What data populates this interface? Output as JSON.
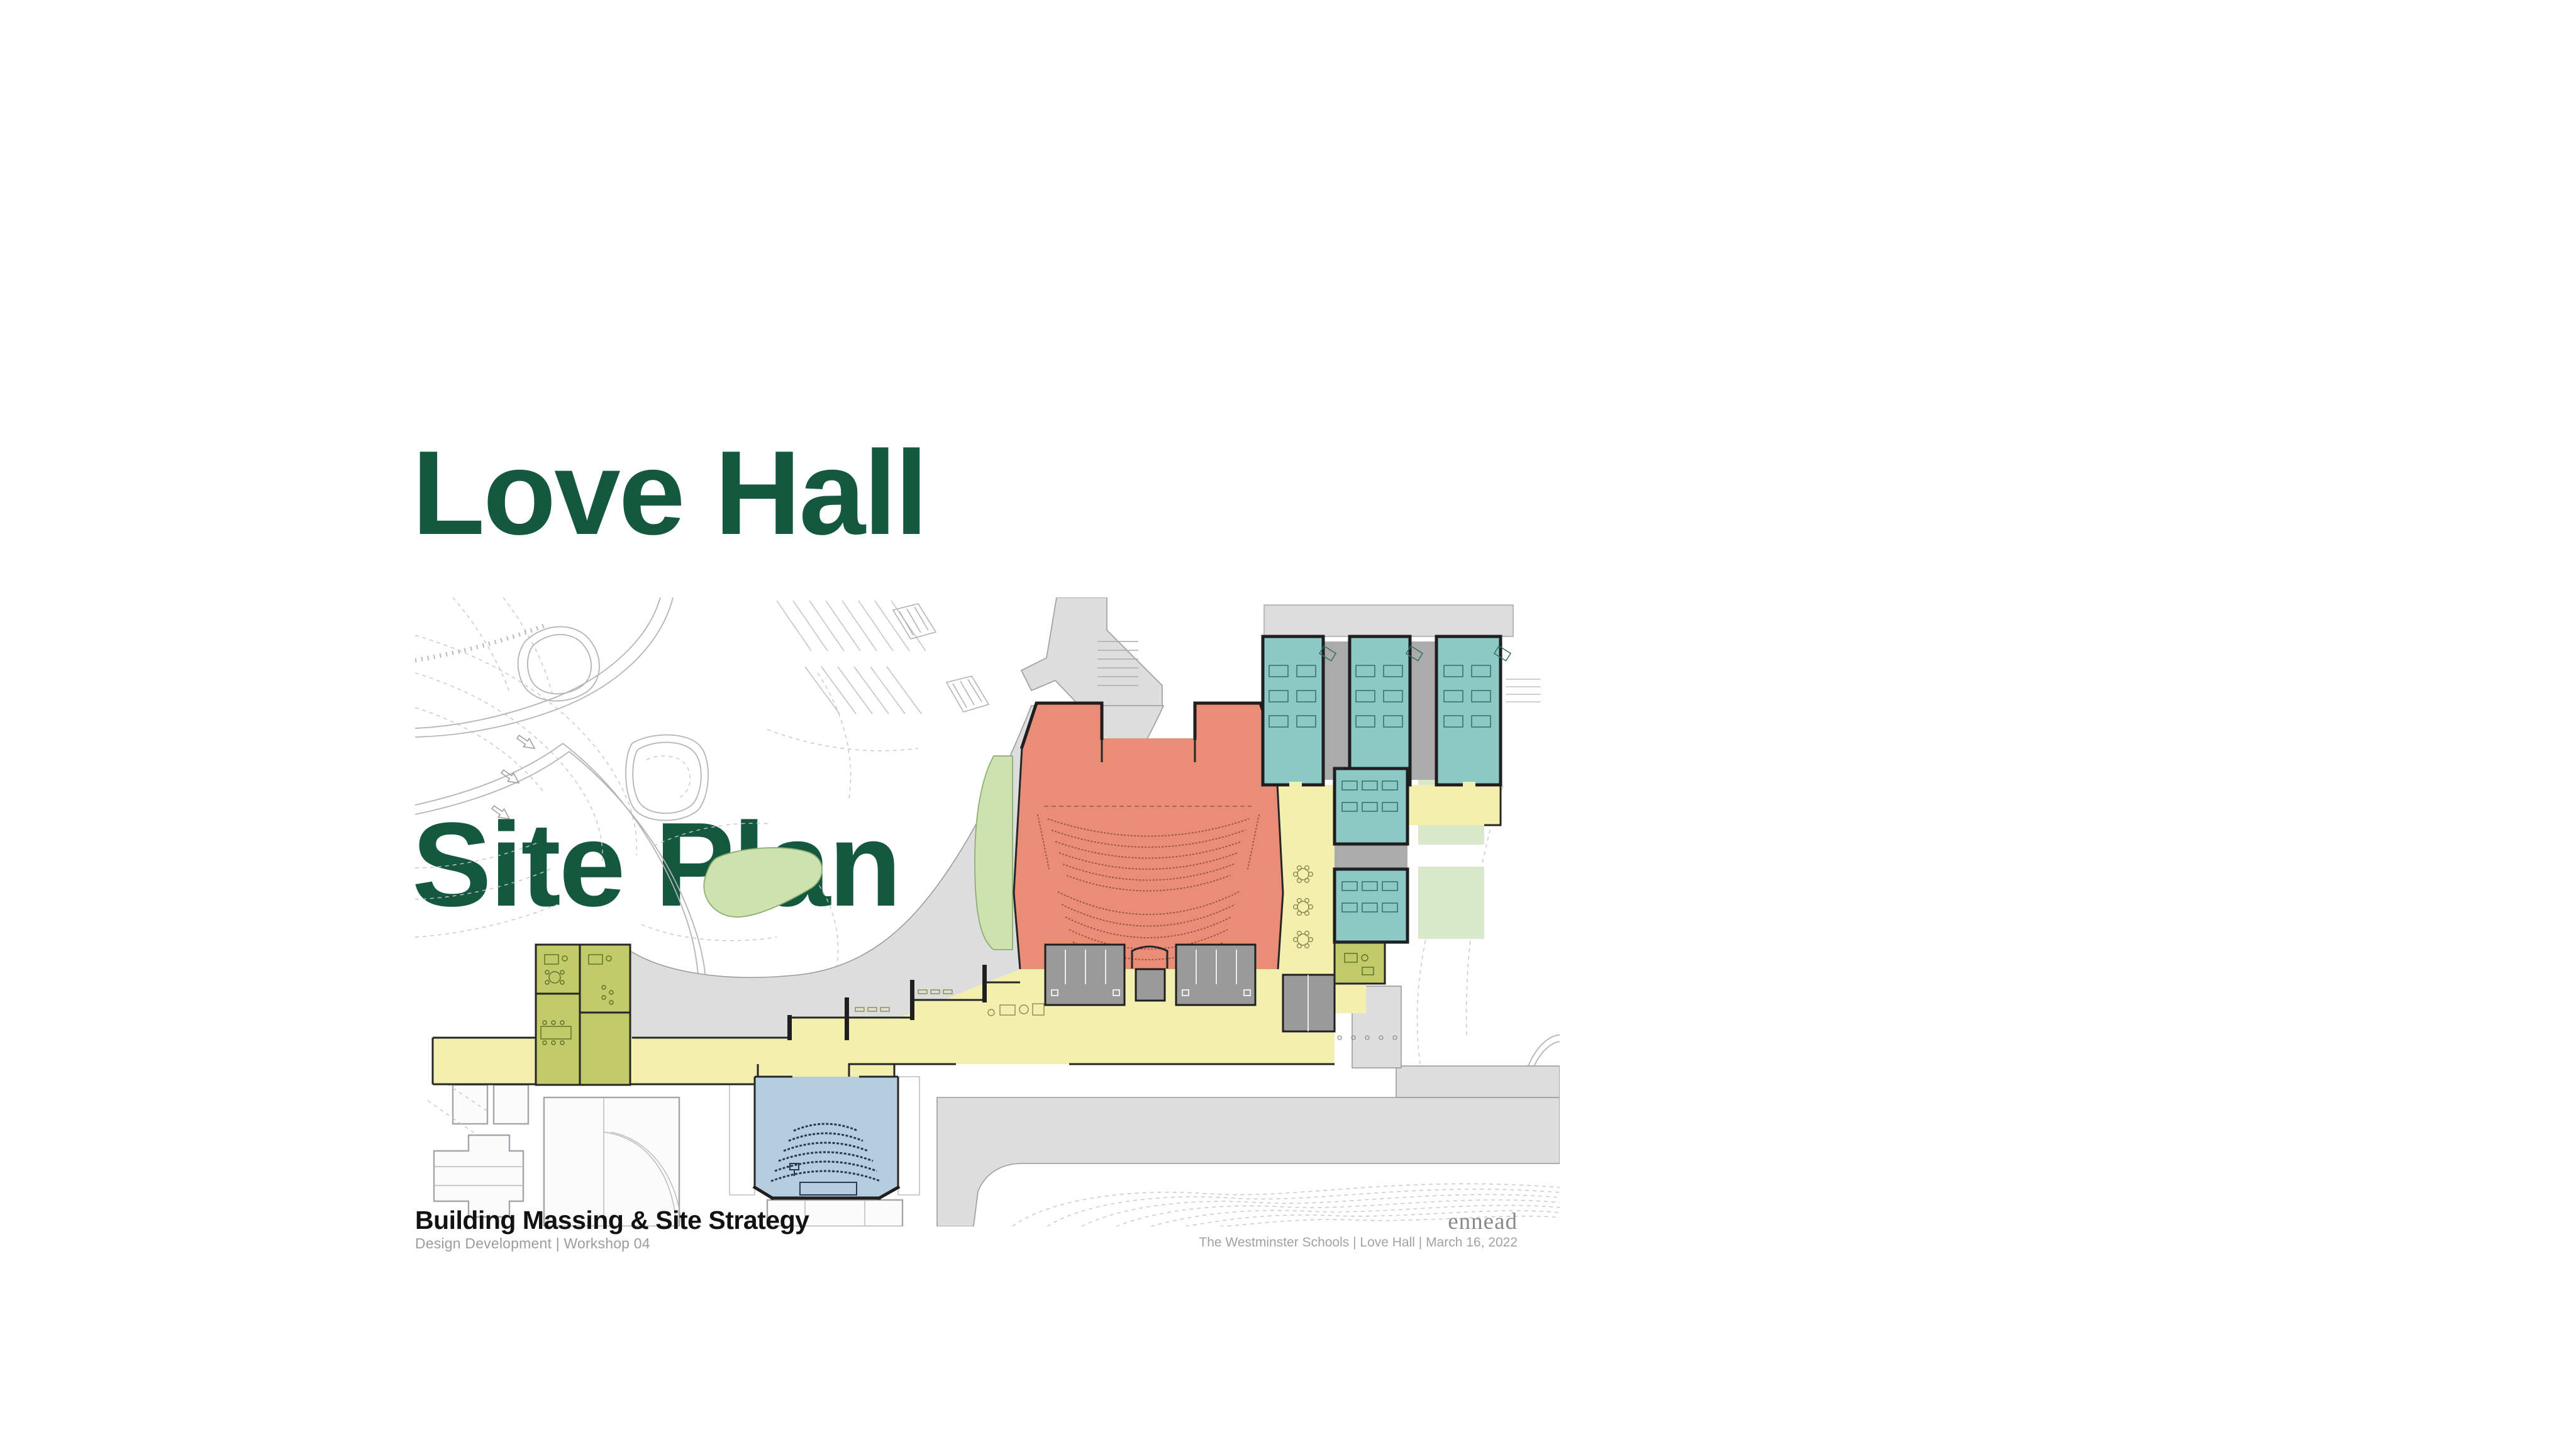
{
  "slide": {
    "title": {
      "line1": "Love Hall",
      "line2": "Site Plan"
    },
    "title_color": "#155840",
    "footer": {
      "section_title": "Building Massing & Site Strategy",
      "section_subtitle": "Design Development  |  Workshop 04",
      "firm_logo": "ennead",
      "project_caption": "The Westminster Schools  |  Love Hall  | March 16, 2022"
    }
  },
  "plan": {
    "description": "Love Hall ground-floor site plan with auditorium, classrooms, lobby circulation, offices, lecture hall, lawns and campus roads",
    "colors": {
      "auditorium": "#EA8D77",
      "classroom": "#8CC8C4",
      "circulation": "#F3F0AF",
      "office": "#C2CB69",
      "lecture_hall": "#B5CDDE",
      "lawn": "#CDE2AE",
      "courtyard": "#D9E8C8",
      "road": "#DDDDDD",
      "terrace": "#DCDCDC",
      "corridor_gray": "#ABABAB",
      "service_gray": "#9A9A9A",
      "wall": "#1F1F1F"
    },
    "regions": [
      {
        "name": "auditorium",
        "color_key": "auditorium"
      },
      {
        "name": "classroom-wing-north",
        "color_key": "classroom"
      },
      {
        "name": "classroom-cluster-east",
        "color_key": "classroom"
      },
      {
        "name": "lobby-circulation",
        "color_key": "circulation"
      },
      {
        "name": "office-suite-west",
        "color_key": "office"
      },
      {
        "name": "lecture-hall-south",
        "color_key": "lecture_hall"
      },
      {
        "name": "lawn-areas",
        "color_key": "lawn"
      },
      {
        "name": "campus-roads",
        "color_key": "road"
      }
    ]
  }
}
